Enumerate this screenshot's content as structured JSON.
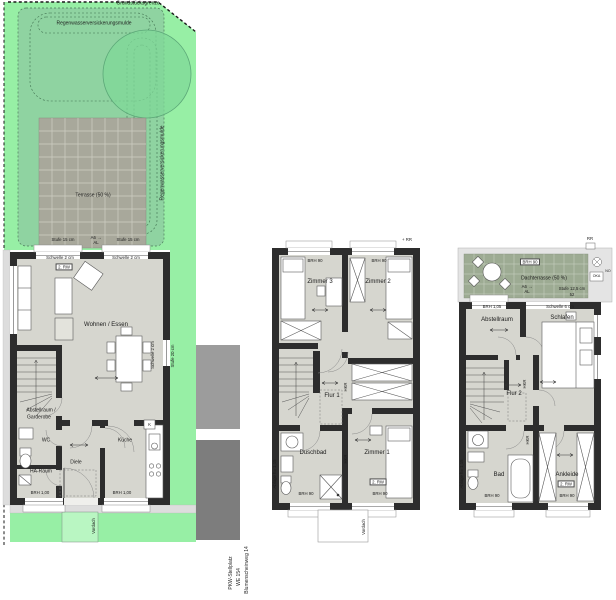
{
  "colors": {
    "garden_bright": "#97efa5",
    "garden_swale": "#8fd3a1",
    "tree": "#7fd898",
    "terrace_tile": "#a8a89b",
    "roof_terrace_tile": "#9dab93",
    "wall": "#2d2d2d",
    "floor": "#d6d6cf",
    "gravel": "#dddddd",
    "parking_dark": "#7d7d7d",
    "parking_light": "#9c9c9c",
    "vordach_green": "#b9f6c2"
  },
  "site": {
    "grenze": "Grundstücksgrenze",
    "mulde": "Regenwasserversickerungsmulde",
    "terrasse": "Terrasse (50 %)",
    "stufe15": "Stufe 15 cm",
    "stufe20": "Stufe 20 cm",
    "a6": "A6 →",
    "al": "AL",
    "vordach": "Vordach"
  },
  "gf": {
    "schwelle2": "Schwelle 2 cm",
    "rw": "2. RW",
    "wohnen": "Wohnen / Essen",
    "abstell1": "Abstellraum /",
    "abstell2": "Garderobe",
    "wc": "WC",
    "ha": "HA-Raum",
    "diele": "Diele",
    "kueche": "Küche",
    "k": "K",
    "brh100": "BRH 1,00"
  },
  "og": {
    "rr": "+ RR",
    "brh90": "BRH 90",
    "zimmer3": "Zimmer 3",
    "zimmer2": "Zimmer 2",
    "zimmer1": "Zimmer 1",
    "flur1": "Flur 1",
    "duschbad": "Duschbad",
    "rw": "2. RW",
    "ablage": "Ablage h= 1,15",
    "hkr": "HKR",
    "vordach": "Vordach"
  },
  "dg": {
    "dachterrasse": "Dachterrasse (50 %)",
    "brh90": "BRH 90",
    "a6": "A6 →",
    "al": "AL",
    "stufe125": "Stufe 12,5 cm",
    "dim52": "52",
    "rr": "RR",
    "oka": "OKA",
    "no": "NO",
    "brh105": "BRH 1,05",
    "schwelle6": "Schwelle 6 cm",
    "abstellraum": "Abstellraum",
    "schlafen": "Schlafen",
    "flur2": "Flur 2",
    "bad": "Bad",
    "ankleide": "Ankleide",
    "rw": "2. RW",
    "ablage": "Ablage h= 1,15",
    "hkr": "HKR"
  },
  "footer": {
    "line1": "PKW-Stellplatz",
    "line2": "WE 154",
    "line3": "Blumenscheinweg 14"
  }
}
